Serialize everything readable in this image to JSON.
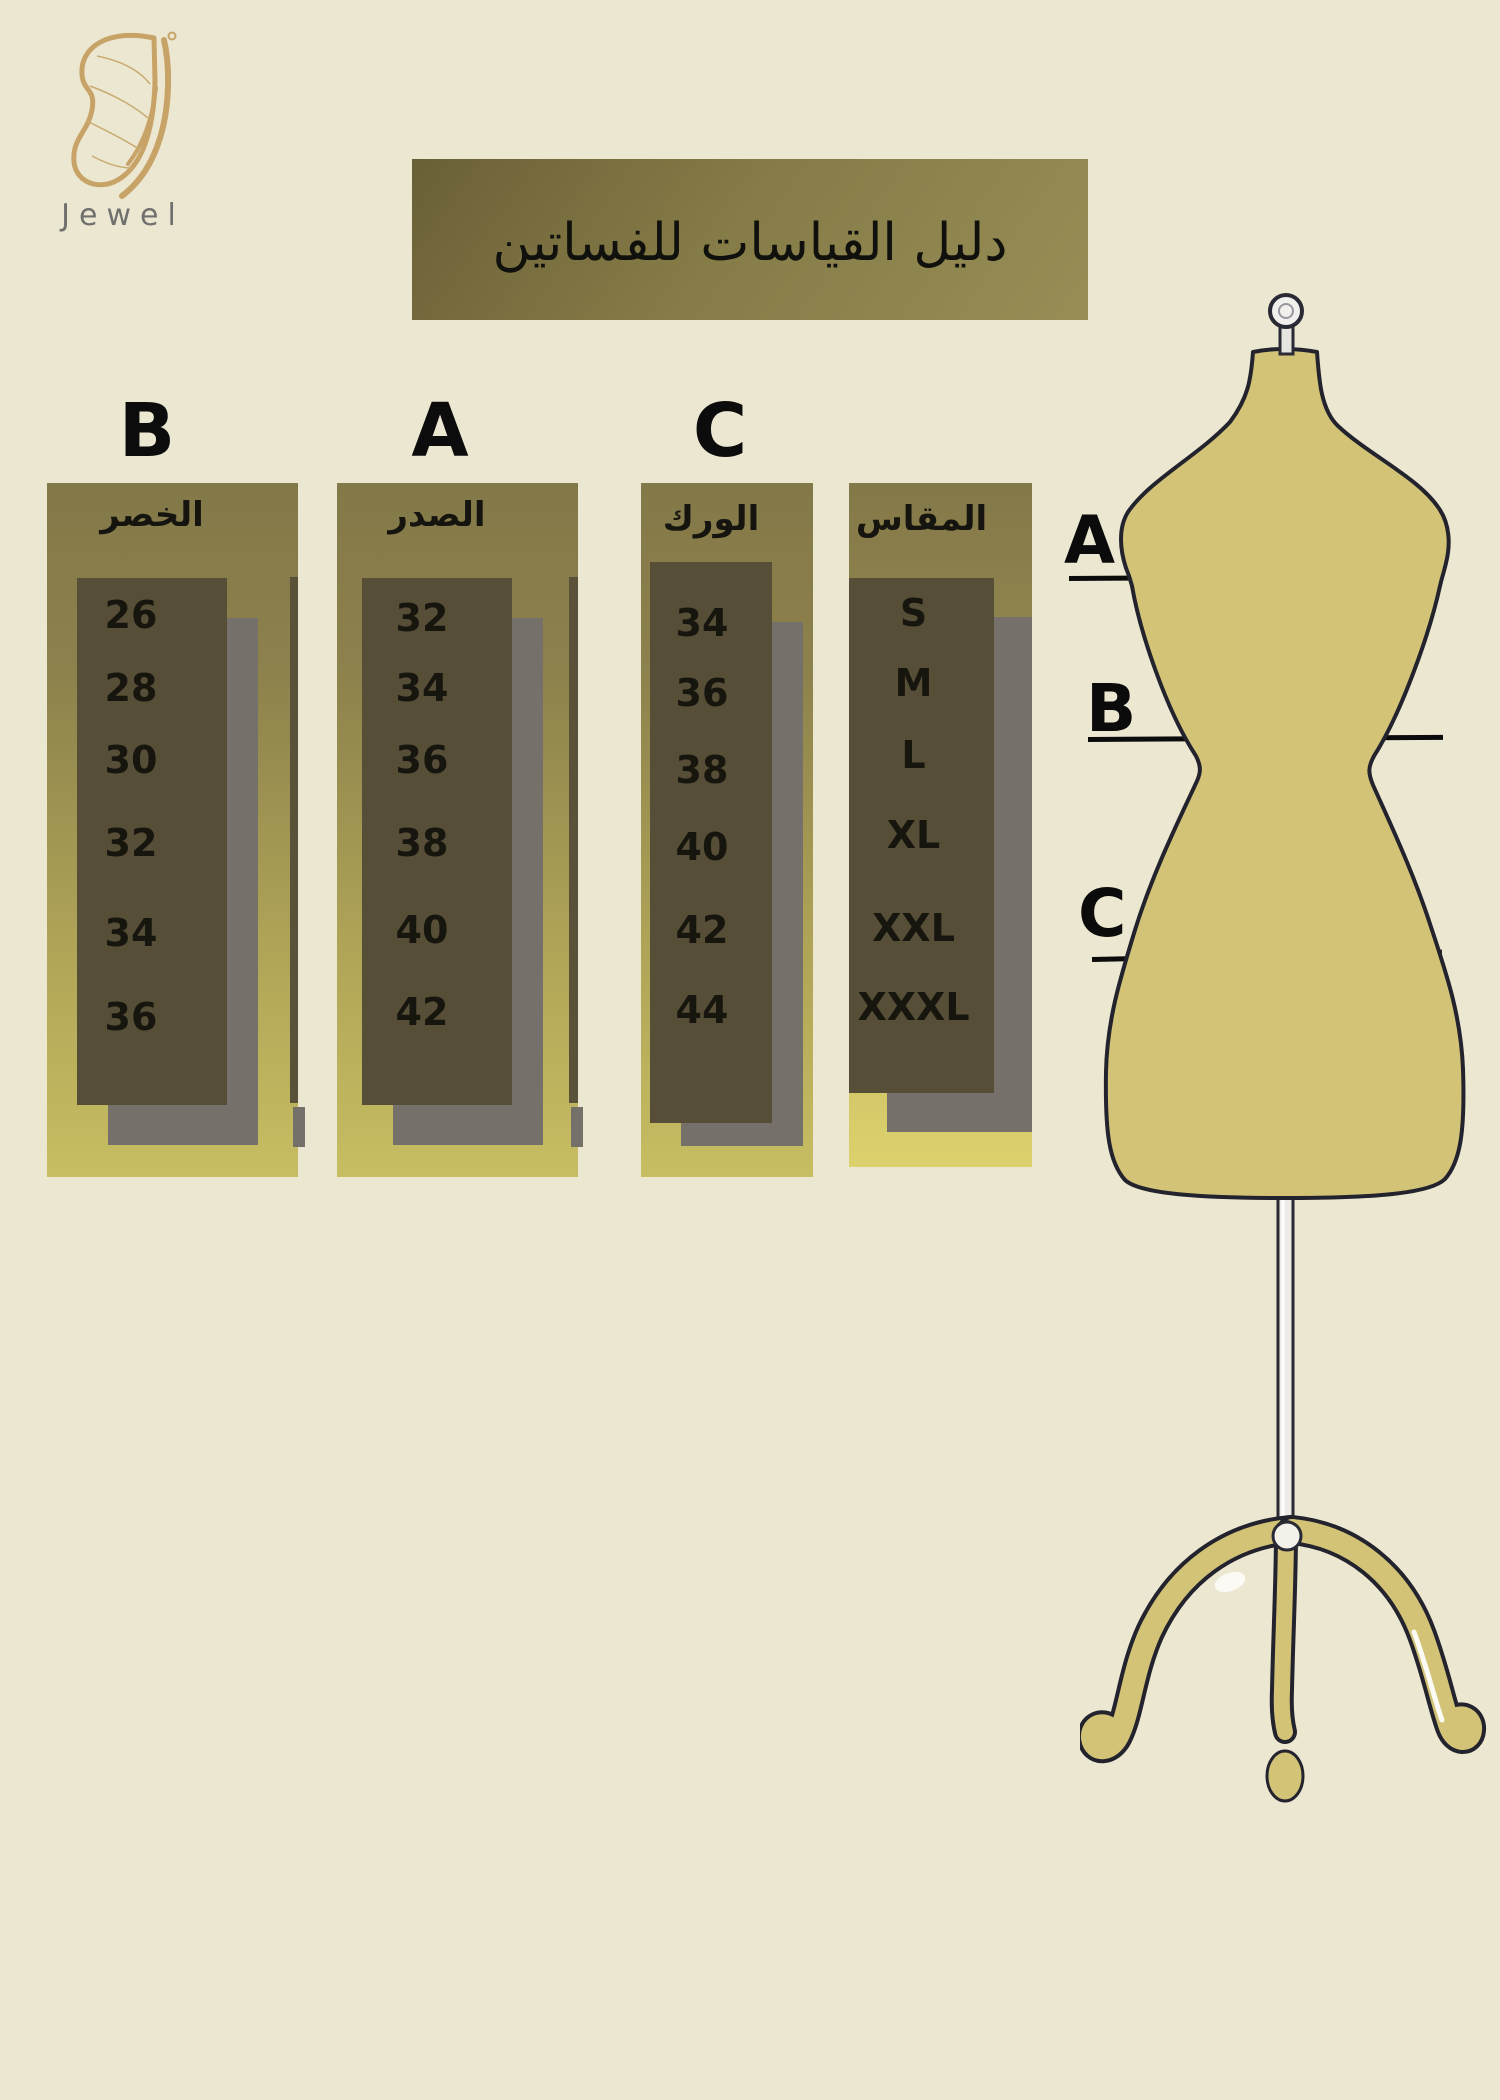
{
  "brand": {
    "name": "Jewel"
  },
  "title": "دليل القياسات للفساتين",
  "size_chart": {
    "columns": [
      {
        "letter": "B",
        "header": "الخصر",
        "values": [
          "26",
          "28",
          "30",
          "32",
          "34",
          "36"
        ]
      },
      {
        "letter": "A",
        "header": "الصدر",
        "values": [
          "32",
          "34",
          "36",
          "38",
          "40",
          "42"
        ]
      },
      {
        "letter": "C",
        "header": "الورك",
        "values": [
          "34",
          "36",
          "38",
          "40",
          "42",
          "44"
        ]
      },
      {
        "header": "المقاس",
        "values": [
          "S",
          "M",
          "L",
          "XL",
          "XXL",
          "XXXL"
        ]
      }
    ]
  },
  "measurement_labels": [
    "A",
    "B",
    "C"
  ],
  "colors": {
    "background": "#ece7d1",
    "banner": "#857b47",
    "panel_gradient_top": "#837848",
    "panel_gradient_bottom": "#c7bd62",
    "size_panel_gradient_bottom": "#ddd16e",
    "table_box": "#564e37",
    "shadow_gray": "#76706a",
    "mannequin_fill": "#d2c377",
    "outline_dark": "#23232e",
    "logo_gold": "#c8a368",
    "brand_text_gray": "#70706e",
    "text_dark": "#15140f"
  }
}
